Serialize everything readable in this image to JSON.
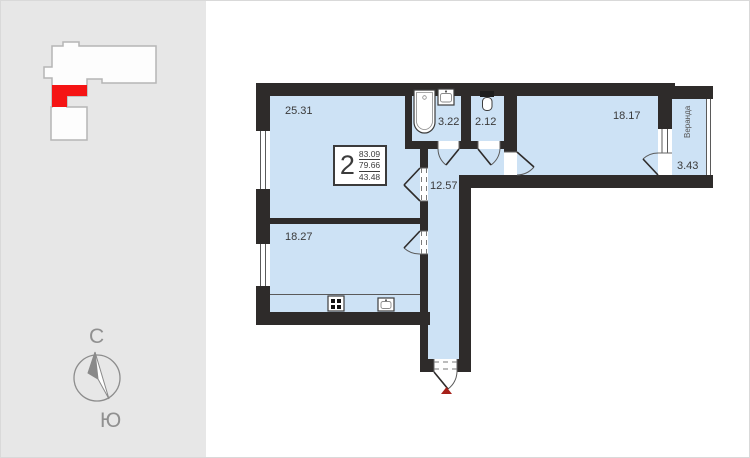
{
  "sidebar": {
    "minimap": {
      "building_fill": "#fdfdfd",
      "building_outline": "#b5b5b5",
      "highlight_color": "#f51414"
    },
    "compass": {
      "north_label": "С",
      "south_label": "Ю"
    }
  },
  "plan": {
    "unit_info": {
      "rooms_count": "2",
      "total_area": "83.09",
      "living_area": "79.66",
      "third_area": "43.48"
    },
    "rooms": [
      {
        "id": "living",
        "area": "25.31"
      },
      {
        "id": "bath",
        "area": "3.22"
      },
      {
        "id": "wc",
        "area": "2.12"
      },
      {
        "id": "bedroom",
        "area": "18.17"
      },
      {
        "id": "veranda",
        "area": "3.43",
        "label": "Веранда"
      },
      {
        "id": "hallway",
        "area": "12.57"
      },
      {
        "id": "kitchen",
        "area": "18.27"
      }
    ],
    "colors": {
      "room_fill": "#cde2f5",
      "wall": "#2e2b2a",
      "entry_marker": "#a62019"
    }
  }
}
